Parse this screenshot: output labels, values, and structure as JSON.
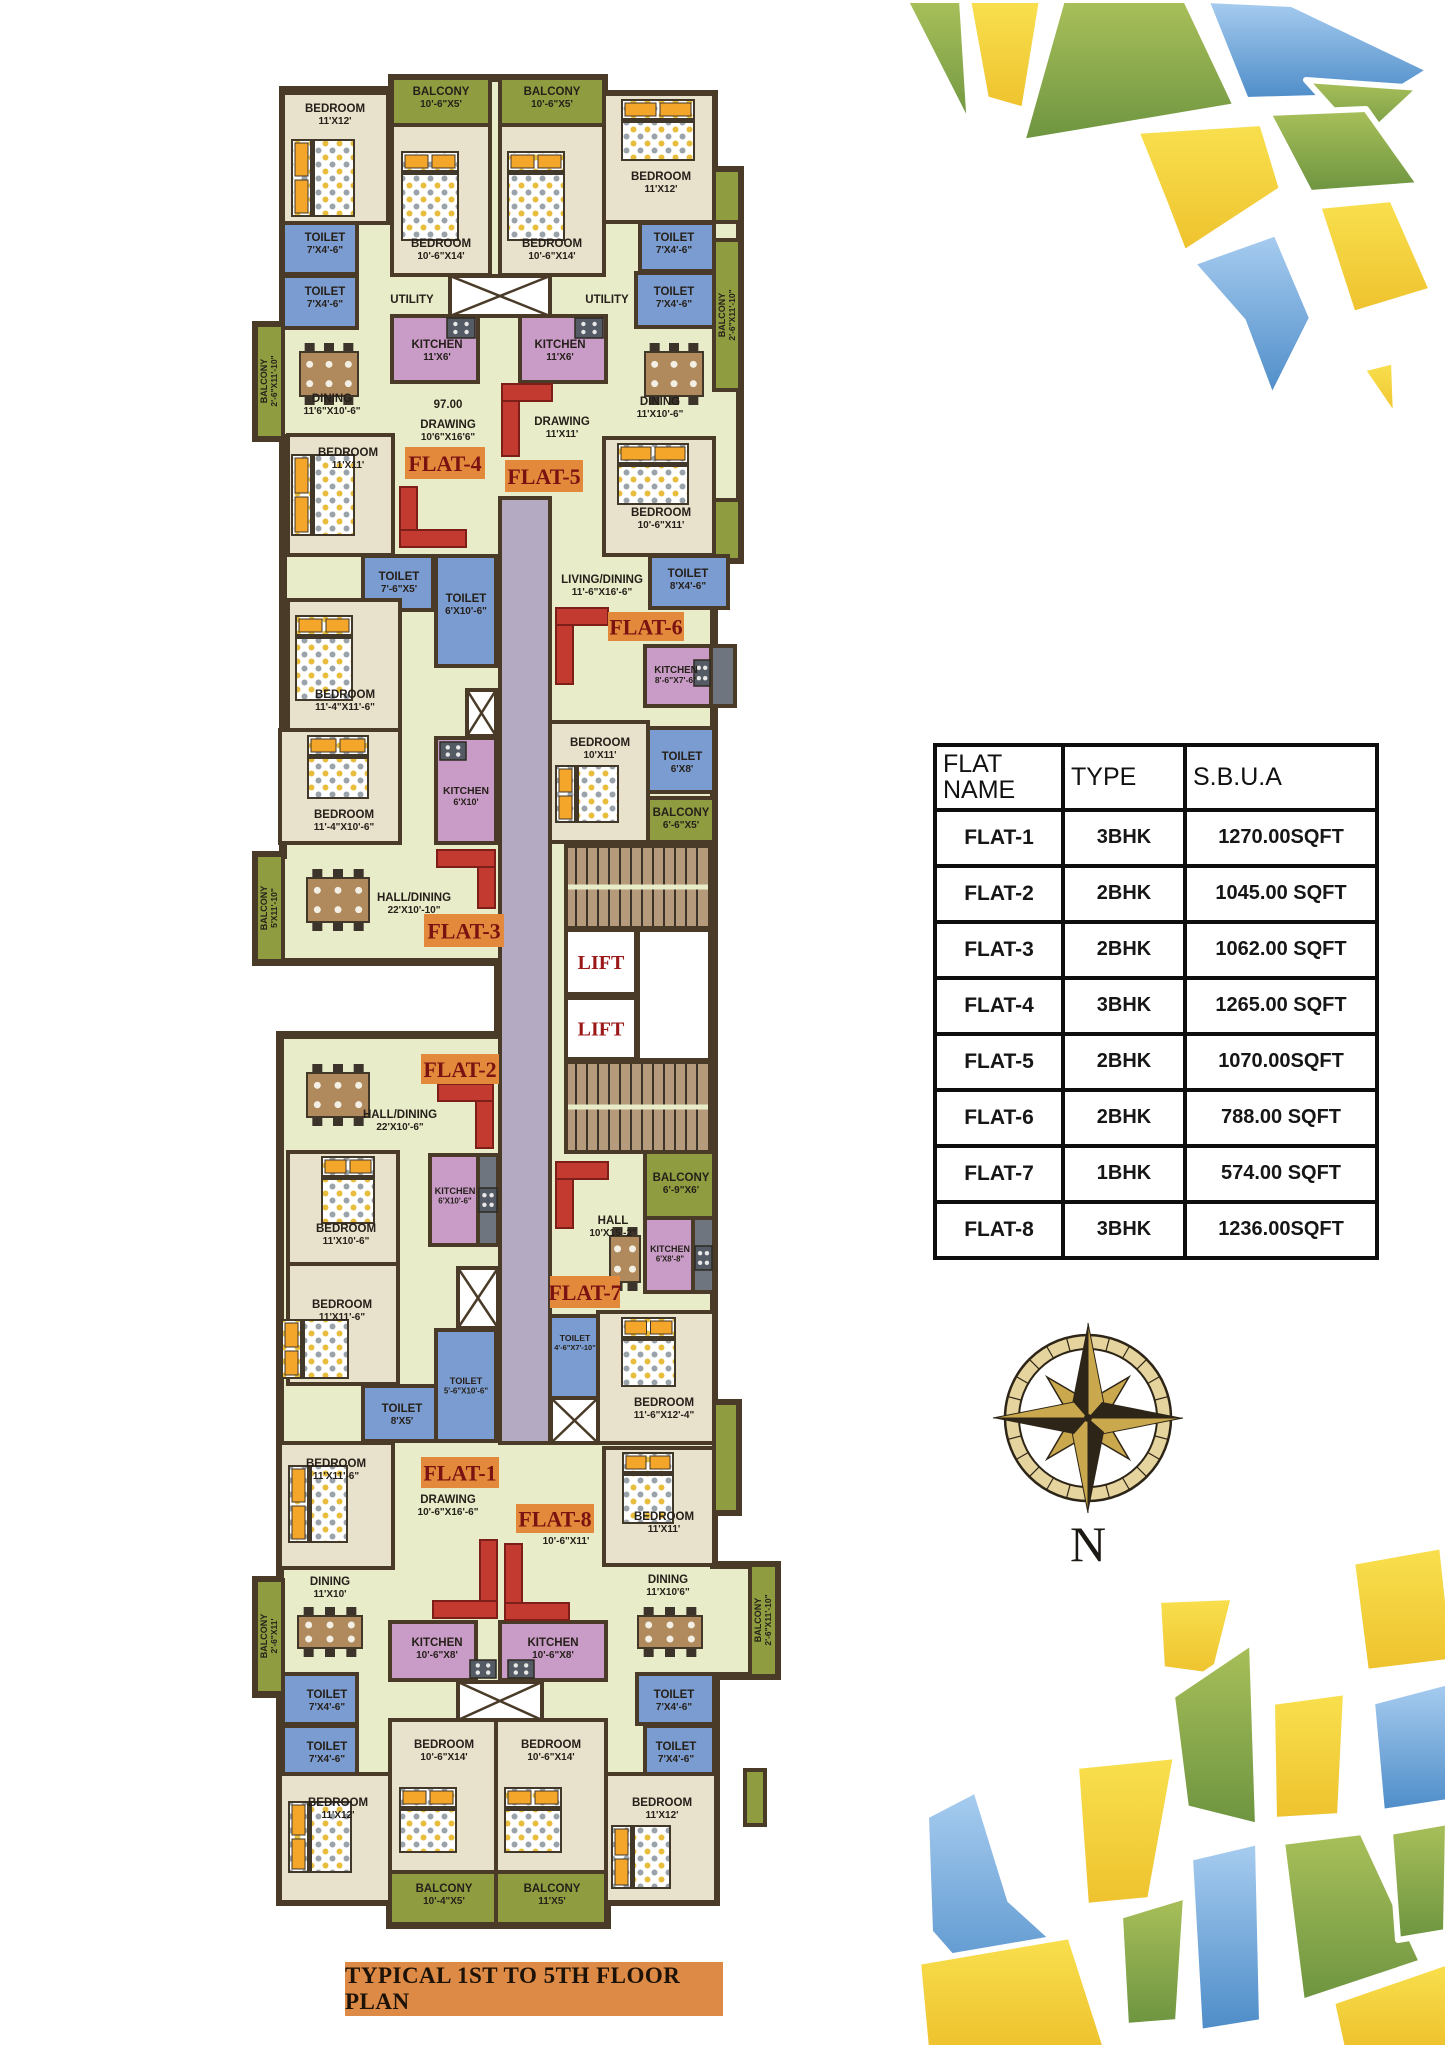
{
  "title": "TYPICAL 1ST TO 5TH FLOOR PLAN",
  "compass": {
    "label": "N"
  },
  "flat_table": {
    "headers": [
      "FLAT NAME",
      "TYPE",
      "S.B.U.A"
    ],
    "rows": [
      {
        "name": "FLAT-1",
        "type": "3BHK",
        "area": "1270.00SQFT"
      },
      {
        "name": "FLAT-2",
        "type": "2BHK",
        "area": "1045.00 SQFT"
      },
      {
        "name": "FLAT-3",
        "type": "2BHK",
        "area": "1062.00 SQFT"
      },
      {
        "name": "FLAT-4",
        "type": "3BHK",
        "area": "1265.00 SQFT"
      },
      {
        "name": "FLAT-5",
        "type": "2BHK",
        "area": "1070.00SQFT"
      },
      {
        "name": "FLAT-6",
        "type": "2BHK",
        "area": "788.00 SQFT"
      },
      {
        "name": "FLAT-7",
        "type": "1BHK",
        "area": "574.00 SQFT"
      },
      {
        "name": "FLAT-8",
        "type": "3BHK",
        "area": "1236.00SQFT"
      }
    ]
  },
  "palette": {
    "wall": "#4a3b28",
    "floor": "#e9ecc9",
    "bedroom": "#e8e1cc",
    "balcony": "#8f9d40",
    "toilet": "#7b9cd0",
    "kitchen": "#c99cc7",
    "corridor": "#b4abc3",
    "stairs": "#b59b7b",
    "shaft": "#ffffff",
    "gray": "#6f757e",
    "lift": "#ffffff",
    "label": "#26201a",
    "flatBox": "#e2893b",
    "flatText": "#7a1212",
    "liftText": "#9c1818",
    "sofa": "#c23a30",
    "bedPillow": "#f4a62a",
    "table": "#b08a5c",
    "mosaicYellow": "#f2cd32",
    "mosaicGreen": "#8cab43",
    "mosaicBlue": "#5c9cd6"
  },
  "flats": [
    {
      "label": "FLAT-4",
      "x": 405,
      "y": 447,
      "w": 80,
      "h": 32
    },
    {
      "label": "FLAT-5",
      "x": 505,
      "y": 460,
      "w": 78,
      "h": 32
    },
    {
      "label": "FLAT-6",
      "x": 608,
      "y": 612,
      "w": 76,
      "h": 29
    },
    {
      "label": "FLAT-3",
      "x": 424,
      "y": 914,
      "w": 80,
      "h": 33
    },
    {
      "label": "FLAT-2",
      "x": 421,
      "y": 1054,
      "w": 78,
      "h": 30
    },
    {
      "label": "FLAT-7",
      "x": 550,
      "y": 1276,
      "w": 70,
      "h": 32
    },
    {
      "label": "FLAT-1",
      "x": 421,
      "y": 1457,
      "w": 78,
      "h": 31
    },
    {
      "label": "FLAT-8",
      "x": 516,
      "y": 1504,
      "w": 78,
      "h": 29
    }
  ],
  "rooms": [
    {
      "f": "bedroom",
      "x": 283,
      "y": 93,
      "w": 105,
      "h": 130,
      "n": "BEDROOM",
      "d": "11'X12'",
      "lx": 335,
      "ly": 112
    },
    {
      "f": "balcony",
      "x": 392,
      "y": 78,
      "w": 98,
      "h": 47,
      "n": "BALCONY",
      "d": "10'-6\"X5'",
      "lx": 441,
      "ly": 95
    },
    {
      "f": "balcony",
      "x": 500,
      "y": 78,
      "w": 104,
      "h": 47,
      "n": "BALCONY",
      "d": "10'-6\"X5'",
      "lx": 552,
      "ly": 95
    },
    {
      "f": "bedroom",
      "x": 392,
      "y": 125,
      "w": 98,
      "h": 150,
      "n": "BEDROOM",
      "d": "10'-6\"X14'",
      "lx": 441,
      "ly": 247
    },
    {
      "f": "bedroom",
      "x": 500,
      "y": 125,
      "w": 104,
      "h": 150,
      "n": "BEDROOM",
      "d": "10'-6\"X14'",
      "lx": 552,
      "ly": 247
    },
    {
      "f": "bedroom",
      "x": 604,
      "y": 94,
      "w": 110,
      "h": 128,
      "n": "BEDROOM",
      "d": "11'X12'",
      "lx": 661,
      "ly": 180
    },
    {
      "f": "balcony",
      "x": 714,
      "y": 170,
      "w": 26,
      "h": 52
    },
    {
      "f": "toilet",
      "x": 283,
      "y": 223,
      "w": 74,
      "h": 51,
      "n": "TOILET",
      "d": "7'X4'-6\"",
      "lx": 325,
      "ly": 241
    },
    {
      "f": "toilet",
      "x": 283,
      "y": 276,
      "w": 74,
      "h": 52,
      "n": "TOILET",
      "d": "7'X4'-6\"",
      "lx": 325,
      "ly": 295
    },
    {
      "f": "toilet",
      "x": 640,
      "y": 223,
      "w": 74,
      "h": 48,
      "n": "TOILET",
      "d": "7'X4'-6\"",
      "lx": 674,
      "ly": 241
    },
    {
      "f": "toilet",
      "x": 636,
      "y": 273,
      "w": 78,
      "h": 54,
      "n": "TOILET",
      "d": "7'X4'-6\"",
      "lx": 674,
      "ly": 295
    },
    {
      "f": "none",
      "n": "UTILITY",
      "lx": 412,
      "ly": 303
    },
    {
      "f": "none",
      "n": "UTILITY",
      "lx": 607,
      "ly": 303
    },
    {
      "f": "shaft",
      "x": 450,
      "y": 276,
      "w": 100,
      "h": 40
    },
    {
      "f": "kitchen",
      "x": 392,
      "y": 316,
      "w": 86,
      "h": 66,
      "n": "KITCHEN",
      "d": "11'X6'",
      "lx": 437,
      "ly": 348
    },
    {
      "f": "kitchen",
      "x": 520,
      "y": 316,
      "w": 86,
      "h": 66,
      "n": "KITCHEN",
      "d": "11'X6'",
      "lx": 560,
      "ly": 348
    },
    {
      "f": "balcony",
      "x": 256,
      "y": 325,
      "w": 27,
      "h": 113,
      "n": "BALCONY",
      "d": "2'-6\"X11'-10\"",
      "v": 1,
      "lx": 269,
      "ly": 381
    },
    {
      "f": "balcony",
      "x": 714,
      "y": 240,
      "w": 26,
      "h": 150,
      "n": "BALCONY",
      "d": "2'-6\"X11'-10\"",
      "v": 1,
      "lx": 727,
      "ly": 315
    },
    {
      "f": "none",
      "n": "DINING",
      "d": "11'6\"X10'-6\"",
      "lx": 332,
      "ly": 402
    },
    {
      "f": "none",
      "n": "DINING",
      "d": "11'X10'-6\"",
      "lx": 660,
      "ly": 405
    },
    {
      "f": "none",
      "n": "97.00",
      "lx": 448,
      "ly": 408
    },
    {
      "f": "none",
      "n": "DRAWING",
      "d": "10'6\"X16'6\"",
      "lx": 448,
      "ly": 428
    },
    {
      "f": "none",
      "n": "DRAWING",
      "d": "11'X11'",
      "lx": 562,
      "ly": 425
    },
    {
      "f": "bedroom",
      "x": 288,
      "y": 435,
      "w": 105,
      "h": 120,
      "n": "BEDROOM",
      "d": "11'X11'",
      "lx": 348,
      "ly": 456
    },
    {
      "f": "bedroom",
      "x": 604,
      "y": 438,
      "w": 110,
      "h": 117,
      "n": "BEDROOM",
      "d": "10'-6\"X11'",
      "lx": 661,
      "ly": 516
    },
    {
      "f": "balcony",
      "x": 714,
      "y": 500,
      "w": 26,
      "h": 60
    },
    {
      "f": "toilet",
      "x": 363,
      "y": 556,
      "w": 70,
      "h": 54,
      "n": "TOILET",
      "d": "7'-6\"X5'",
      "lx": 399,
      "ly": 580
    },
    {
      "f": "toilet",
      "x": 436,
      "y": 556,
      "w": 60,
      "h": 110,
      "n": "TOILET",
      "d": "6'X10'-6\"",
      "lx": 466,
      "ly": 602
    },
    {
      "f": "toilet",
      "x": 650,
      "y": 556,
      "w": 78,
      "h": 52,
      "n": "TOILET",
      "d": "8'X4'-6\"",
      "lx": 688,
      "ly": 577
    },
    {
      "f": "none",
      "n": "LIVING/DINING",
      "d": "11'-6\"X16'-6\"",
      "lx": 602,
      "ly": 583
    },
    {
      "f": "kitchen",
      "x": 645,
      "y": 646,
      "w": 66,
      "h": 60,
      "n": "KITCHEN",
      "d": "8'-6\"X7'-6\"",
      "lx": 676,
      "ly": 673,
      "fs": 0.85
    },
    {
      "f": "gray",
      "x": 711,
      "y": 646,
      "w": 24,
      "h": 60
    },
    {
      "f": "bedroom",
      "x": 288,
      "y": 600,
      "w": 112,
      "h": 130,
      "n": "BEDROOM",
      "d": "11'-4\"X11'-6\"",
      "lx": 345,
      "ly": 698
    },
    {
      "f": "bedroom",
      "x": 280,
      "y": 730,
      "w": 120,
      "h": 113,
      "n": "BEDROOM",
      "d": "11'-4\"X10'-6\"",
      "lx": 344,
      "ly": 818
    },
    {
      "f": "kitchen",
      "x": 436,
      "y": 738,
      "w": 60,
      "h": 105,
      "n": "KITCHEN",
      "d": "6'X10'",
      "lx": 466,
      "ly": 794,
      "fs": 0.9
    },
    {
      "f": "shaft",
      "x": 467,
      "y": 690,
      "w": 29,
      "h": 46
    },
    {
      "f": "bedroom",
      "x": 550,
      "y": 722,
      "w": 98,
      "h": 120,
      "n": "BEDROOM",
      "d": "10'X11'",
      "lx": 600,
      "ly": 746
    },
    {
      "f": "toilet",
      "x": 648,
      "y": 728,
      "w": 66,
      "h": 64,
      "n": "TOILET",
      "d": "6'X8'",
      "lx": 682,
      "ly": 760
    },
    {
      "f": "balcony",
      "x": 648,
      "y": 798,
      "w": 66,
      "h": 44,
      "n": "BALCONY",
      "d": "6'-6\"X5'",
      "lx": 681,
      "ly": 816
    },
    {
      "f": "none",
      "n": "HALL/DINING",
      "d": "22'X10'-10\"",
      "lx": 414,
      "ly": 901
    },
    {
      "f": "balcony",
      "x": 256,
      "y": 855,
      "w": 27,
      "h": 106,
      "n": "BALCONY",
      "d": "5'X11'-10\"",
      "v": 1,
      "lx": 269,
      "ly": 908
    },
    {
      "f": "corridor",
      "x": 500,
      "y": 498,
      "w": 50,
      "h": 945
    },
    {
      "f": "stairs",
      "x": 566,
      "y": 846,
      "w": 144,
      "h": 82
    },
    {
      "f": "lift",
      "x": 566,
      "y": 930,
      "w": 70,
      "h": 64,
      "n": "LIFT"
    },
    {
      "f": "lift",
      "x": 638,
      "y": 930,
      "w": 72,
      "h": 130
    },
    {
      "f": "lift",
      "x": 566,
      "y": 998,
      "w": 70,
      "h": 61,
      "n": "LIFT"
    },
    {
      "f": "stairs",
      "x": 566,
      "y": 1062,
      "w": 144,
      "h": 90
    },
    {
      "f": "none",
      "n": "HALL/DINING",
      "d": "22'X10'-6\"",
      "lx": 400,
      "ly": 1118
    },
    {
      "f": "kitchen",
      "x": 430,
      "y": 1155,
      "w": 48,
      "h": 90,
      "n": "KITCHEN",
      "d": "6'X10'-6\"",
      "lx": 455,
      "ly": 1194,
      "fs": 0.8
    },
    {
      "f": "gray",
      "x": 478,
      "y": 1155,
      "w": 20,
      "h": 90
    },
    {
      "f": "bedroom",
      "x": 288,
      "y": 1152,
      "w": 110,
      "h": 112,
      "n": "BEDROOM",
      "d": "11'X10'-6\"",
      "lx": 346,
      "ly": 1232
    },
    {
      "f": "bedroom",
      "x": 288,
      "y": 1264,
      "w": 110,
      "h": 120,
      "n": "BEDROOM",
      "d": "11'X11'-6\"",
      "lx": 342,
      "ly": 1308
    },
    {
      "f": "shaft",
      "x": 458,
      "y": 1268,
      "w": 40,
      "h": 60
    },
    {
      "f": "toilet",
      "x": 363,
      "y": 1386,
      "w": 74,
      "h": 55,
      "n": "TOILET",
      "d": "8'X5'",
      "lx": 402,
      "ly": 1412
    },
    {
      "f": "toilet",
      "x": 436,
      "y": 1330,
      "w": 60,
      "h": 111,
      "n": "TOILET",
      "d": "5'-6\"X10'-6\"",
      "lx": 466,
      "ly": 1384,
      "fs": 0.8
    },
    {
      "f": "bedroom",
      "x": 280,
      "y": 1443,
      "w": 113,
      "h": 125,
      "n": "BEDROOM",
      "d": "11'X11'-6\"",
      "lx": 336,
      "ly": 1467
    },
    {
      "f": "none",
      "n": "DRAWING",
      "d": "10'-6\"X16'-6\"",
      "lx": 448,
      "ly": 1503
    },
    {
      "f": "toilet",
      "x": 550,
      "y": 1316,
      "w": 48,
      "h": 82,
      "n": "TOILET",
      "d": "4'-6\"X7'-10\"",
      "lx": 575,
      "ly": 1341,
      "fs": 0.75
    },
    {
      "f": "shaft",
      "x": 551,
      "y": 1398,
      "w": 47,
      "h": 45
    },
    {
      "f": "bedroom",
      "x": 598,
      "y": 1312,
      "w": 116,
      "h": 131,
      "n": "BEDROOM",
      "d": "11'-6\"X12'-4\"",
      "lx": 664,
      "ly": 1406
    },
    {
      "f": "bedroom",
      "x": 604,
      "y": 1448,
      "w": 110,
      "h": 117,
      "n": "BEDROOM",
      "d": "11'X11'",
      "lx": 664,
      "ly": 1520
    },
    {
      "f": "balcony",
      "x": 714,
      "y": 1403,
      "w": 24,
      "h": 109
    },
    {
      "f": "none",
      "n": "DRAWING",
      "d": "10'-6\"X11'",
      "lx": 566,
      "ly": 1532
    },
    {
      "f": "none",
      "n": "HALL",
      "d": "10'X15'-2\"",
      "lx": 613,
      "ly": 1224
    },
    {
      "f": "balcony",
      "x": 645,
      "y": 1152,
      "w": 69,
      "h": 66,
      "n": "BALCONY",
      "d": "6'-9\"X6'",
      "lx": 681,
      "ly": 1181
    },
    {
      "f": "kitchen",
      "x": 645,
      "y": 1218,
      "w": 48,
      "h": 74,
      "n": "KITCHEN",
      "d": "6'X8'-8\"",
      "lx": 670,
      "ly": 1252,
      "fs": 0.78
    },
    {
      "f": "gray",
      "x": 693,
      "y": 1218,
      "w": 21,
      "h": 74
    },
    {
      "f": "none",
      "n": "DINING",
      "d": "11'X10'",
      "lx": 330,
      "ly": 1585
    },
    {
      "f": "none",
      "n": "DINING",
      "d": "11'X10'6\"",
      "lx": 668,
      "ly": 1583
    },
    {
      "f": "kitchen",
      "x": 390,
      "y": 1622,
      "w": 86,
      "h": 58,
      "n": "KITCHEN",
      "d": "10'-6\"X8'",
      "lx": 437,
      "ly": 1646
    },
    {
      "f": "kitchen",
      "x": 500,
      "y": 1622,
      "w": 106,
      "h": 58,
      "n": "KITCHEN",
      "d": "10'-6\"X8'",
      "lx": 553,
      "ly": 1646
    },
    {
      "f": "toilet",
      "x": 283,
      "y": 1674,
      "w": 74,
      "h": 50,
      "n": "TOILET",
      "d": "7'X4'-6\"",
      "lx": 327,
      "ly": 1698
    },
    {
      "f": "toilet",
      "x": 283,
      "y": 1726,
      "w": 74,
      "h": 50,
      "n": "TOILET",
      "d": "7'X4'-6\"",
      "lx": 327,
      "ly": 1750
    },
    {
      "f": "toilet",
      "x": 637,
      "y": 1674,
      "w": 77,
      "h": 50,
      "n": "TOILET",
      "d": "7'X4'-6\"",
      "lx": 674,
      "ly": 1698
    },
    {
      "f": "toilet",
      "x": 645,
      "y": 1726,
      "w": 69,
      "h": 50,
      "n": "TOILET",
      "d": "7'X4'-6\"",
      "lx": 676,
      "ly": 1750
    },
    {
      "f": "shaft",
      "x": 458,
      "y": 1682,
      "w": 84,
      "h": 38
    },
    {
      "f": "bedroom",
      "x": 390,
      "y": 1720,
      "w": 106,
      "h": 152,
      "n": "BEDROOM",
      "d": "10'-6\"X14'",
      "lx": 444,
      "ly": 1748
    },
    {
      "f": "bedroom",
      "x": 496,
      "y": 1720,
      "w": 110,
      "h": 152,
      "n": "BEDROOM",
      "d": "10'-6\"X14'",
      "lx": 551,
      "ly": 1748
    },
    {
      "f": "bedroom",
      "x": 280,
      "y": 1774,
      "w": 110,
      "h": 128,
      "n": "BEDROOM",
      "d": "11'X12'",
      "lx": 338,
      "ly": 1806
    },
    {
      "f": "bedroom",
      "x": 606,
      "y": 1774,
      "w": 110,
      "h": 128,
      "n": "BEDROOM",
      "d": "11'X12'",
      "lx": 662,
      "ly": 1806
    },
    {
      "f": "balcony",
      "x": 390,
      "y": 1872,
      "w": 106,
      "h": 52,
      "n": "BALCONY",
      "d": "10'-4\"X5'",
      "lx": 444,
      "ly": 1892
    },
    {
      "f": "balcony",
      "x": 496,
      "y": 1872,
      "w": 110,
      "h": 52,
      "n": "BALCONY",
      "d": "11'X5'",
      "lx": 552,
      "ly": 1892
    },
    {
      "f": "balcony",
      "x": 750,
      "y": 1565,
      "w": 27,
      "h": 111,
      "n": "BALCONY",
      "d": "2'-6\"X11'-10\"",
      "v": 1,
      "lx": 763,
      "ly": 1620
    },
    {
      "f": "balcony",
      "x": 256,
      "y": 1580,
      "w": 27,
      "h": 113,
      "n": "BALCONY",
      "d": "2'-6\"X11'",
      "v": 1,
      "lx": 269,
      "ly": 1636
    },
    {
      "f": "balcony",
      "x": 745,
      "y": 1770,
      "w": 20,
      "h": 55
    }
  ],
  "furniture": {
    "beds": [
      {
        "x": 292,
        "y": 140,
        "w": 62,
        "h": 76,
        "o": "h"
      },
      {
        "x": 402,
        "y": 152,
        "w": 56,
        "h": 88,
        "o": "v"
      },
      {
        "x": 508,
        "y": 152,
        "w": 56,
        "h": 88,
        "o": "v"
      },
      {
        "x": 622,
        "y": 100,
        "w": 72,
        "h": 60,
        "o": "v"
      },
      {
        "x": 292,
        "y": 455,
        "w": 62,
        "h": 80,
        "o": "h"
      },
      {
        "x": 618,
        "y": 444,
        "w": 70,
        "h": 60,
        "o": "v"
      },
      {
        "x": 296,
        "y": 616,
        "w": 56,
        "h": 84,
        "o": "v"
      },
      {
        "x": 308,
        "y": 736,
        "w": 60,
        "h": 62,
        "o": "v"
      },
      {
        "x": 556,
        "y": 766,
        "w": 62,
        "h": 56,
        "o": "h"
      },
      {
        "x": 322,
        "y": 1157,
        "w": 52,
        "h": 66,
        "o": "v"
      },
      {
        "x": 282,
        "y": 1320,
        "w": 66,
        "h": 58,
        "o": "h"
      },
      {
        "x": 289,
        "y": 1466,
        "w": 58,
        "h": 76,
        "o": "h"
      },
      {
        "x": 622,
        "y": 1318,
        "w": 53,
        "h": 68,
        "o": "v"
      },
      {
        "x": 623,
        "y": 1453,
        "w": 50,
        "h": 70,
        "o": "v"
      },
      {
        "x": 400,
        "y": 1788,
        "w": 56,
        "h": 64,
        "o": "v"
      },
      {
        "x": 505,
        "y": 1788,
        "w": 56,
        "h": 64,
        "o": "v"
      },
      {
        "x": 289,
        "y": 1802,
        "w": 62,
        "h": 70,
        "o": "h"
      },
      {
        "x": 612,
        "y": 1826,
        "w": 58,
        "h": 62,
        "o": "h"
      }
    ],
    "sofas": [
      {
        "x": 400,
        "y": 487,
        "w": 66,
        "h": 60,
        "c": "bl"
      },
      {
        "x": 502,
        "y": 384,
        "w": 50,
        "h": 72,
        "c": "tl"
      },
      {
        "x": 556,
        "y": 608,
        "w": 52,
        "h": 76,
        "c": "tl"
      },
      {
        "x": 437,
        "y": 850,
        "w": 58,
        "h": 58,
        "c": "tr"
      },
      {
        "x": 438,
        "y": 1084,
        "w": 55,
        "h": 64,
        "c": "tr"
      },
      {
        "x": 556,
        "y": 1162,
        "w": 52,
        "h": 66,
        "c": "tl"
      },
      {
        "x": 433,
        "y": 1540,
        "w": 64,
        "h": 78,
        "c": "br"
      },
      {
        "x": 505,
        "y": 1544,
        "w": 64,
        "h": 76,
        "c": "bl"
      }
    ],
    "tables": [
      {
        "x": 300,
        "y": 352,
        "w": 58,
        "h": 44,
        "n": 6
      },
      {
        "x": 645,
        "y": 352,
        "w": 58,
        "h": 44,
        "n": 6
      },
      {
        "x": 307,
        "y": 878,
        "w": 62,
        "h": 44,
        "n": 6
      },
      {
        "x": 307,
        "y": 1073,
        "w": 62,
        "h": 44,
        "n": 6
      },
      {
        "x": 610,
        "y": 1236,
        "w": 30,
        "h": 46,
        "n": 4
      },
      {
        "x": 298,
        "y": 1616,
        "w": 64,
        "h": 32,
        "n": 6
      },
      {
        "x": 638,
        "y": 1616,
        "w": 64,
        "h": 32,
        "n": 6
      }
    ],
    "stoves": [
      {
        "x": 447,
        "y": 318,
        "w": 28,
        "h": 20
      },
      {
        "x": 575,
        "y": 318,
        "w": 28,
        "h": 20
      },
      {
        "x": 694,
        "y": 660,
        "w": 16,
        "h": 26
      },
      {
        "x": 440,
        "y": 742,
        "w": 26,
        "h": 18
      },
      {
        "x": 479,
        "y": 1188,
        "w": 18,
        "h": 24
      },
      {
        "x": 695,
        "y": 1246,
        "w": 17,
        "h": 24
      },
      {
        "x": 470,
        "y": 1660,
        "w": 26,
        "h": 18
      },
      {
        "x": 508,
        "y": 1660,
        "w": 26,
        "h": 18
      }
    ]
  }
}
